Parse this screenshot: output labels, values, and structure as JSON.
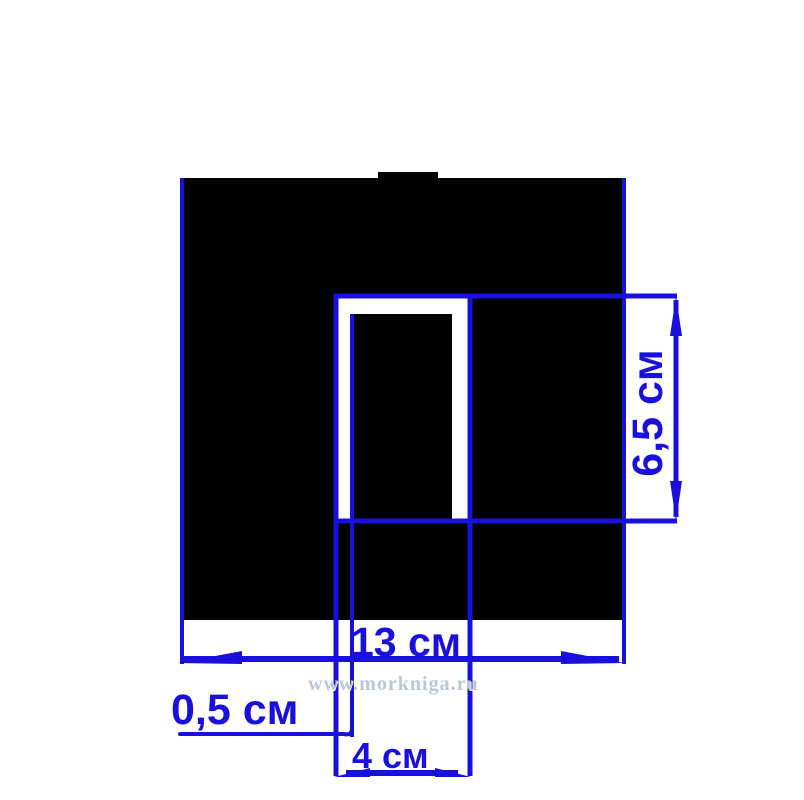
{
  "title": "Dimensioned drawing of a black square plate with a U-shaped slot",
  "colors": {
    "accent": "#1a10dd",
    "shape": "#000000",
    "background": "#ffffff",
    "watermark": "#bac7d9"
  },
  "dimensions": {
    "plate_width": {
      "label": "13 см",
      "value_cm": 13,
      "orientation": "horizontal"
    },
    "slot_depth": {
      "label": "6,5 см",
      "value_cm": 6.5,
      "orientation": "vertical"
    },
    "slot_wall_gap": {
      "label": "0,5 см",
      "value_cm": 0.5,
      "orientation": "leader"
    },
    "slot_width": {
      "label": "4 см",
      "value_cm": 4,
      "orientation": "horizontal"
    }
  },
  "watermark": {
    "text": "www.morkniga.ru"
  }
}
